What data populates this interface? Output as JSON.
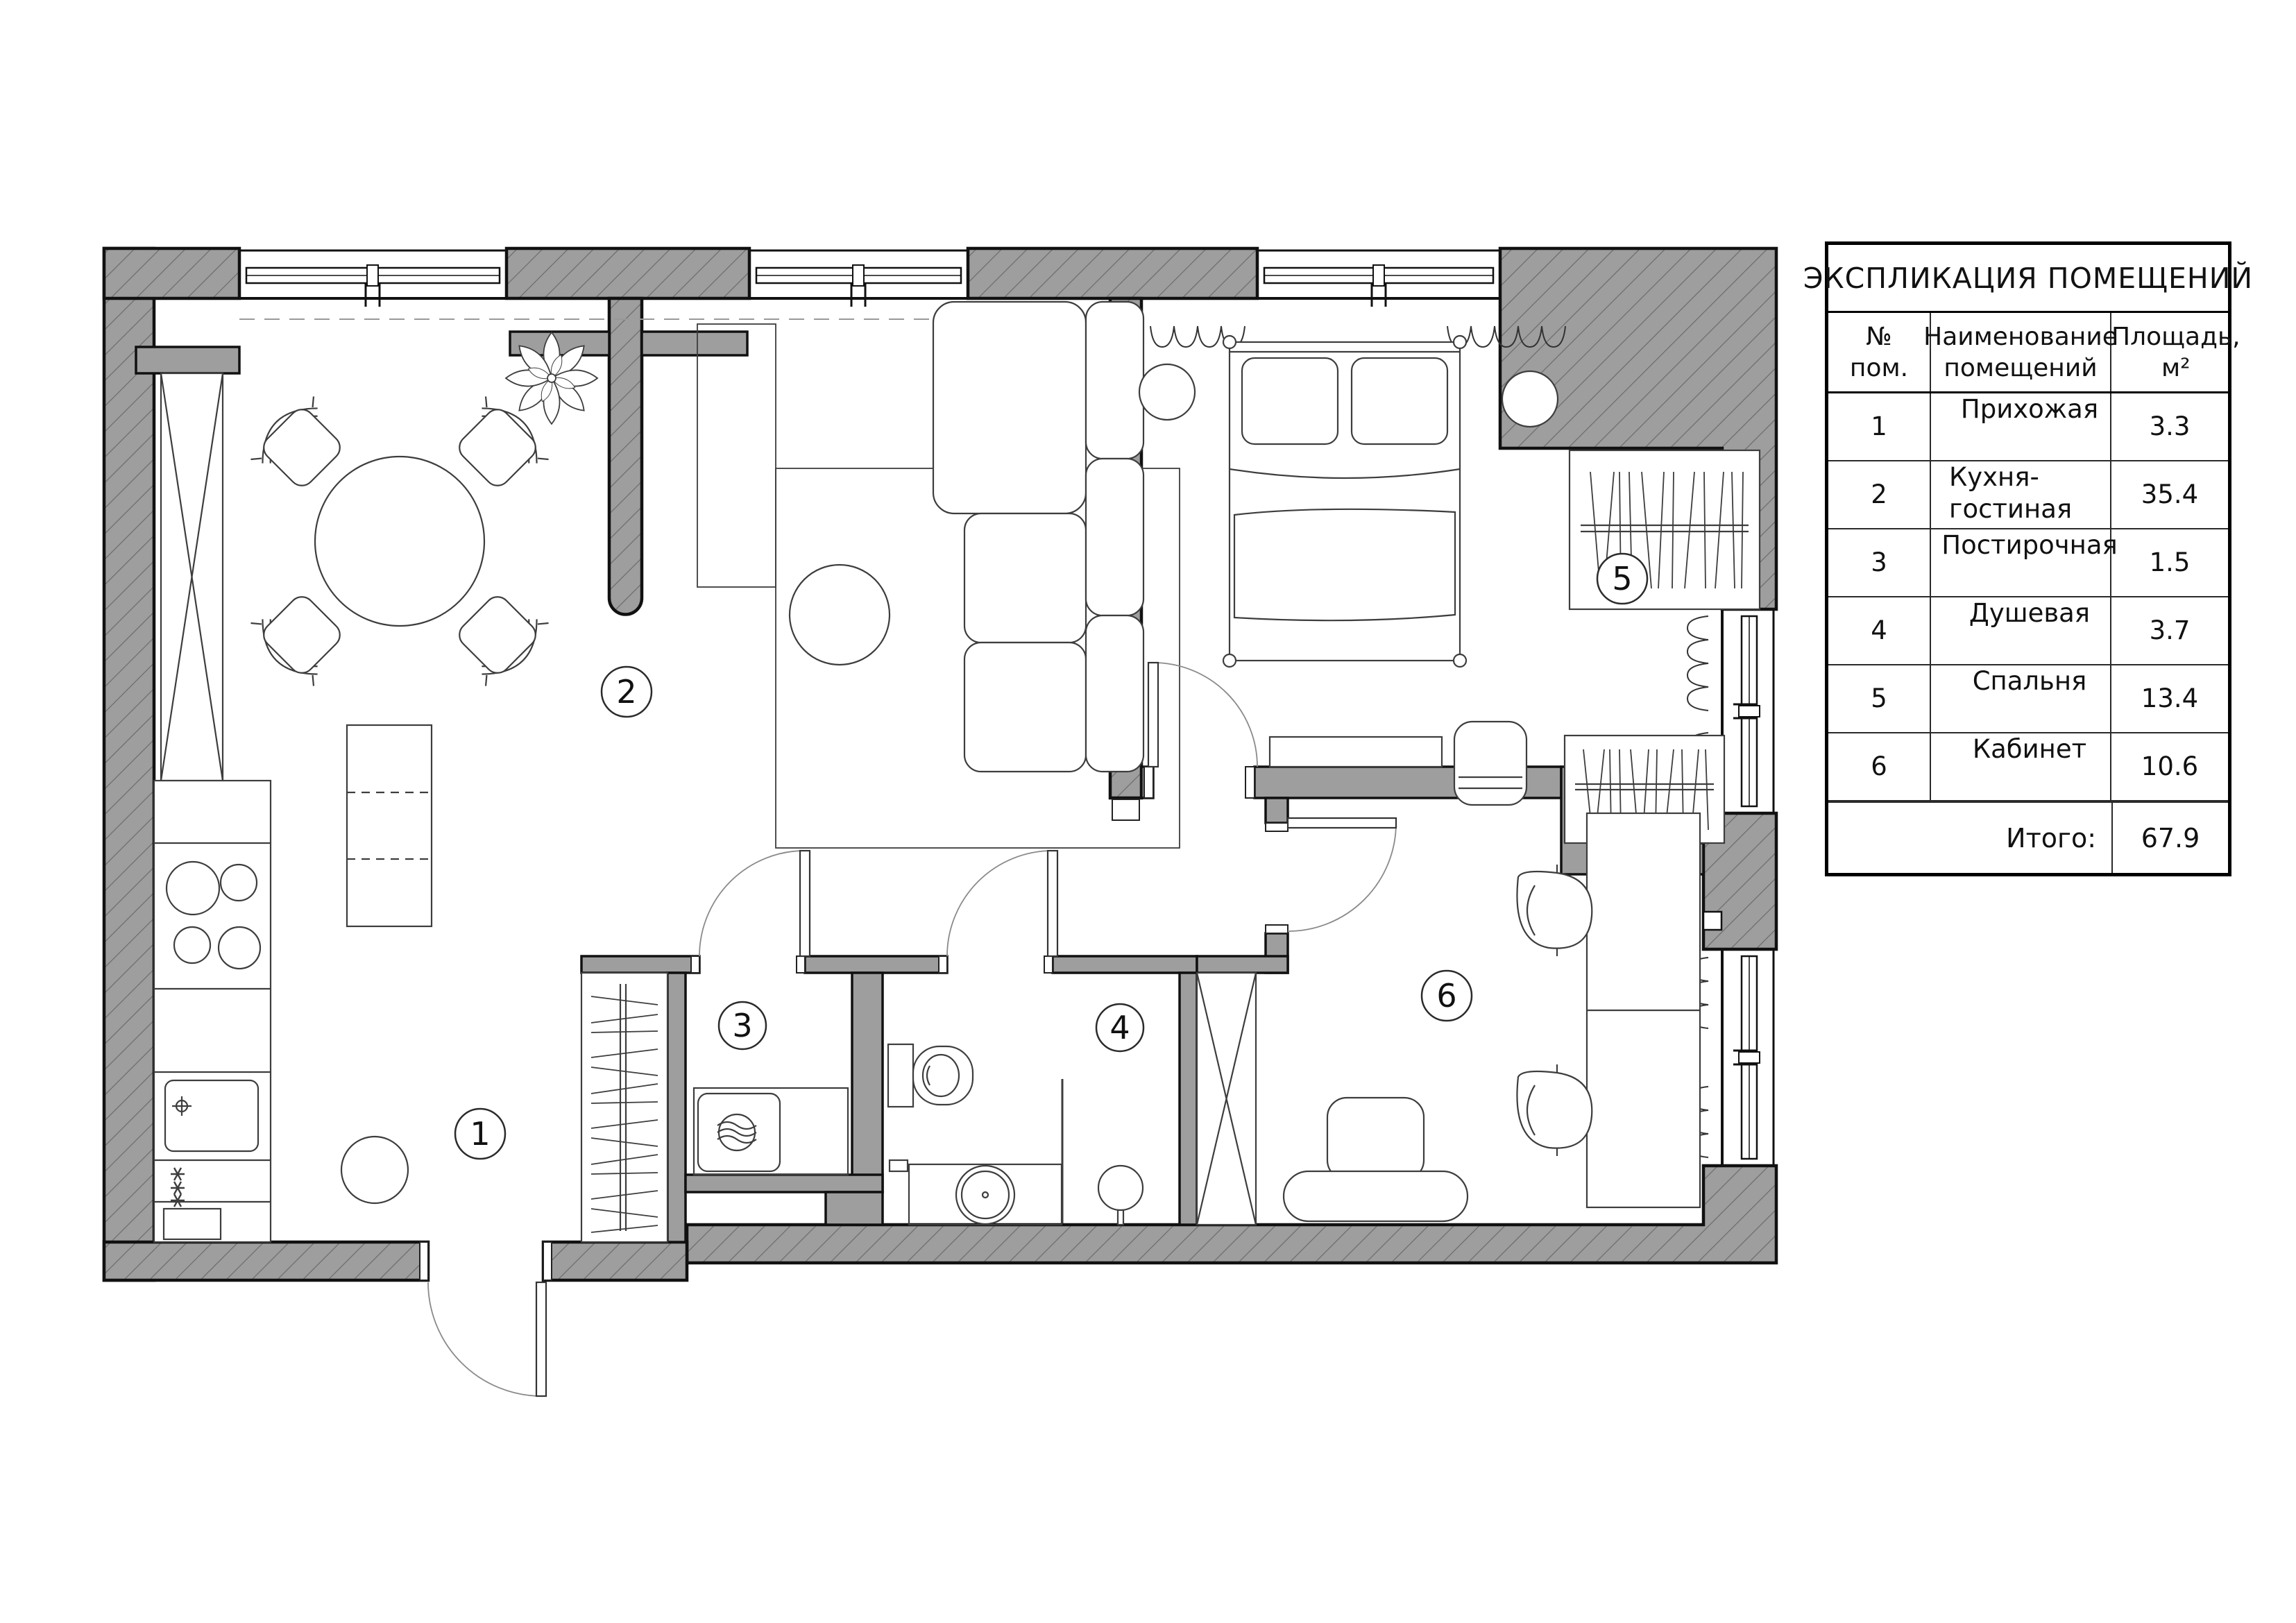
{
  "legend": {
    "title": "ЭКСПЛИКАЦИЯ ПОМЕЩЕНИЙ",
    "columns": {
      "num_line1": "№",
      "num_line2": "пом.",
      "name_line1": "Наименование",
      "name_line2": "помещений",
      "area_line1": "Площадь,",
      "area_line2": "м²"
    },
    "rows": [
      {
        "num": "1",
        "name": "Прихожая",
        "area": "3.3"
      },
      {
        "num": "2",
        "name": "Кухня-гостиная",
        "area": "35.4"
      },
      {
        "num": "3",
        "name": "Постирочная",
        "area": "1.5"
      },
      {
        "num": "4",
        "name": "Душевая",
        "area": "3.7"
      },
      {
        "num": "5",
        "name": "Спальня",
        "area": "13.4"
      },
      {
        "num": "6",
        "name": "Кабинет",
        "area": "10.6"
      }
    ],
    "total_label": "Итого:",
    "total_value": "67.9"
  },
  "rooms": [
    {
      "number": "1",
      "name": "Прихожая"
    },
    {
      "number": "2",
      "name": "Кухня-гостиная"
    },
    {
      "number": "3",
      "name": "Постирочная"
    },
    {
      "number": "4",
      "name": "Душевая"
    },
    {
      "number": "5",
      "name": "Спальня"
    },
    {
      "number": "6",
      "name": "Кабинет"
    }
  ],
  "colors": {
    "wall_fill": "#9e9e9e",
    "wall_hatch": "#6d6d6d",
    "outline": "#111111",
    "furniture_stroke": "#3d3d3d",
    "background": "#ffffff"
  }
}
